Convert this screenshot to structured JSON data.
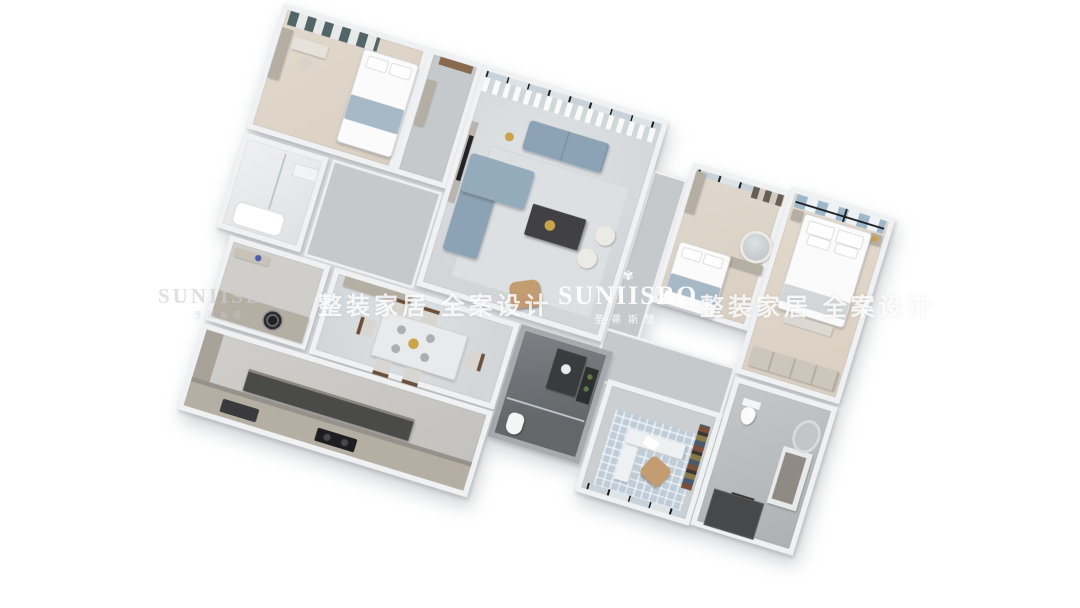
{
  "watermarks": {
    "brand_latin": "SUNIISBO",
    "brand_chinese": "圣蒂斯堡",
    "crest_glyph": "✾",
    "tagline": "整装家居 全案设计"
  },
  "palette": {
    "background": "#ffffff",
    "wall": "#eff1f3",
    "floor-marble": "#d3d6d8",
    "floor-wood": "#d9cfc2",
    "floor-hall": "#c6c9cb",
    "floor-dark-bath": "#64676a",
    "sofa-blue": "#8ba3b4",
    "headboard-blue": "#9db8cb",
    "curtain-teal": "#42595c",
    "leather-tan": "#c39c72",
    "counter-dark": "#414143",
    "cabinet-greige": "#b5aea3",
    "rug-blue": "#bfcdd8",
    "gold": "#c9a44a"
  }
}
